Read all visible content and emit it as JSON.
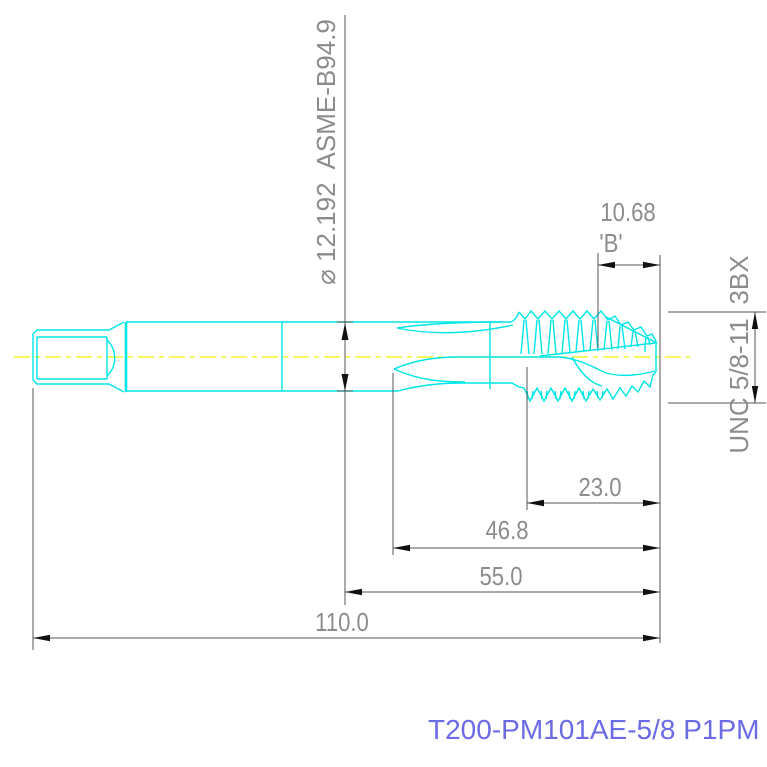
{
  "drawing": {
    "part_number": "T200-PM101AE-5/8 P1PM",
    "labels": {
      "shank_dia": "⌀ 12.192  ASME-B94.9",
      "chamfer_len": "10.68",
      "chamfer_ref": "'B'",
      "thread_class": "3BX",
      "thread_spec": "UNC 5/8-11",
      "len_thread": "23.0",
      "len_flute": "46.8",
      "len_front": "55.0",
      "len_overall": "110.0"
    },
    "colors": {
      "tool_outline": "#00e6e6",
      "centerline": "#f2f200",
      "dimension_lines": "#555555",
      "dimension_text": "#8c8c8c",
      "arrowheads": "#111111",
      "part_number_text": "#6b6be6",
      "background": "#ffffff"
    }
  }
}
